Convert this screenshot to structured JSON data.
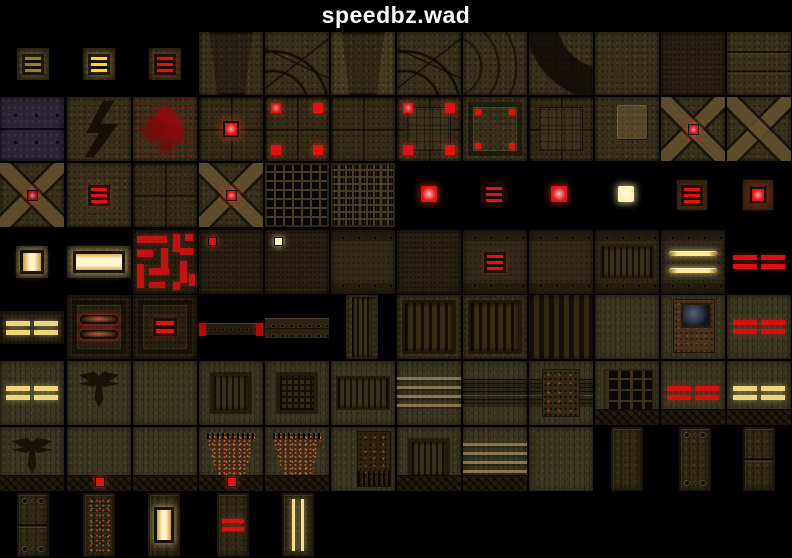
{
  "header": {
    "title": "speedbz.wad"
  },
  "palette": {
    "background": "#000000",
    "title_text": "#ffffff",
    "red_light": "#e01212",
    "red_glow": "rgba(255,60,30,0.45)",
    "yellow_light": "#ffd81e",
    "yellow_pairs": "#edd77a",
    "dim_yellow": "#97831e",
    "white_light": "#fff3b0",
    "brown_base": "#39301c",
    "olive_base": "#3b3622"
  },
  "tiles": [
    {
      "name": "light-sm-yellow-dim",
      "x": 17,
      "y": 48,
      "w": 32,
      "h": 32,
      "b": "brown",
      "l": [
        "bars3"
      ],
      "a": "#97831e",
      "g": "rgba(200,180,70,0.4)"
    },
    {
      "name": "light-sm-yellow",
      "x": 83,
      "y": 48,
      "w": 32,
      "h": 32,
      "b": "brown",
      "l": [
        "bars3"
      ],
      "a": "#ffd81e",
      "g": "rgba(255,220,80,0.5)"
    },
    {
      "name": "light-sm-red",
      "x": 149,
      "y": 48,
      "w": 32,
      "h": 32,
      "b": "brown",
      "l": [
        "bars3"
      ]
    },
    {
      "name": "arch-keystone-dark",
      "x": 199,
      "y": 32,
      "w": 64,
      "h": 63,
      "b": "brown",
      "l": [
        "trap"
      ]
    },
    {
      "name": "arch-stones",
      "x": 265,
      "y": 32,
      "w": 64,
      "h": 63,
      "b": "brown",
      "l": [
        "stones"
      ]
    },
    {
      "name": "arch-keystone",
      "x": 331,
      "y": 32,
      "w": 64,
      "h": 63,
      "b": "brownb",
      "l": [
        "trap"
      ]
    },
    {
      "name": "arch-corner-stones",
      "x": 397,
      "y": 32,
      "w": 64,
      "h": 63,
      "b": "brown",
      "l": [
        "stones"
      ]
    },
    {
      "name": "arch-curve-lines",
      "x": 463,
      "y": 32,
      "w": 64,
      "h": 63,
      "b": "brown",
      "l": [
        "arcs"
      ]
    },
    {
      "name": "arch-curve-dark",
      "x": 529,
      "y": 32,
      "w": 64,
      "h": 63,
      "b": "brown",
      "l": [
        "arcdark"
      ]
    },
    {
      "name": "wall-plain",
      "x": 595,
      "y": 32,
      "w": 64,
      "h": 63,
      "b": "brown",
      "l": []
    },
    {
      "name": "wall-dark",
      "x": 661,
      "y": 32,
      "w": 64,
      "h": 63,
      "b": "brownd",
      "l": []
    },
    {
      "name": "wall-seams",
      "x": 727,
      "y": 32,
      "w": 64,
      "h": 63,
      "b": "brown",
      "l": [
        "seams"
      ]
    },
    {
      "name": "plate-rivets",
      "x": 0,
      "y": 97,
      "w": 64,
      "h": 64,
      "b": "plates",
      "l": []
    },
    {
      "name": "wall-conduit-bolt",
      "x": 67,
      "y": 97,
      "w": 64,
      "h": 64,
      "b": "brown",
      "l": [
        "zigzag"
      ]
    },
    {
      "name": "wall-blood",
      "x": 133,
      "y": 97,
      "w": 64,
      "h": 64,
      "b": "brown",
      "l": [
        "blood"
      ]
    },
    {
      "name": "floor-light-center",
      "x": 199,
      "y": 97,
      "w": 64,
      "h": 64,
      "b": "floor",
      "l": [
        "glowc"
      ]
    },
    {
      "name": "floor-lights-corners",
      "x": 265,
      "y": 97,
      "w": 64,
      "h": 64,
      "b": "floor",
      "l": [
        "corners"
      ]
    },
    {
      "name": "floor-plain",
      "x": 331,
      "y": 97,
      "w": 64,
      "h": 64,
      "b": "floor",
      "l": []
    },
    {
      "name": "floor-lights-corners-grid",
      "x": 397,
      "y": 97,
      "w": 64,
      "h": 64,
      "b": "floor",
      "l": [
        "insetgrid",
        "corners"
      ]
    },
    {
      "name": "panel-corner-lights",
      "x": 463,
      "y": 97,
      "w": 64,
      "h": 64,
      "b": "brown",
      "l": [
        "frame",
        "cornerdots"
      ]
    },
    {
      "name": "floor-inset-grid",
      "x": 529,
      "y": 97,
      "w": 64,
      "h": 64,
      "b": "floor",
      "l": [
        "insetgrid"
      ]
    },
    {
      "name": "wall-hatch-panel",
      "x": 595,
      "y": 97,
      "w": 64,
      "h": 64,
      "b": "brown",
      "l": [
        "panellight"
      ]
    },
    {
      "name": "cross-light-red",
      "x": 661,
      "y": 97,
      "w": 64,
      "h": 64,
      "b": "brown",
      "l": [
        "xcross",
        "dotglow"
      ]
    },
    {
      "name": "cross-plain",
      "x": 727,
      "y": 97,
      "w": 64,
      "h": 64,
      "b": "brown",
      "l": [
        "xcross"
      ]
    },
    {
      "name": "cross-light-dim",
      "x": 0,
      "y": 163,
      "w": 64,
      "h": 64,
      "b": "brown",
      "l": [
        "xcross",
        "dotglow"
      ],
      "a": "#a31010",
      "g": "rgba(200,40,25,0.3)"
    },
    {
      "name": "wall-red-bars",
      "x": 67,
      "y": 163,
      "w": 64,
      "h": 64,
      "b": "brown",
      "l": [
        "bars3"
      ]
    },
    {
      "name": "floor-tiles",
      "x": 133,
      "y": 163,
      "w": 64,
      "h": 64,
      "b": "floor",
      "l": []
    },
    {
      "name": "cross-light-red2",
      "x": 199,
      "y": 163,
      "w": 64,
      "h": 64,
      "b": "brown",
      "l": [
        "xcross",
        "dotglow"
      ]
    },
    {
      "name": "grate-dark",
      "x": 265,
      "y": 163,
      "w": 64,
      "h": 64,
      "b": "grate",
      "l": []
    },
    {
      "name": "grate-dense",
      "x": 331,
      "y": 163,
      "w": 64,
      "h": 64,
      "b": "grate2",
      "l": []
    },
    {
      "name": "light-red-sq",
      "x": 420,
      "y": 185,
      "w": 18,
      "h": 18,
      "b": "black",
      "l": [
        "glowfill"
      ]
    },
    {
      "name": "light-red-bars",
      "x": 485,
      "y": 185,
      "w": 18,
      "h": 18,
      "b": "black",
      "l": [
        "bars3"
      ]
    },
    {
      "name": "light-red-spike",
      "x": 550,
      "y": 185,
      "w": 18,
      "h": 18,
      "b": "black",
      "l": [
        "glowfill"
      ]
    },
    {
      "name": "light-white-spike",
      "x": 617,
      "y": 185,
      "w": 18,
      "h": 18,
      "b": "black",
      "l": [
        "glowfill"
      ],
      "a": "#fff3b0",
      "g": "rgba(255,240,180,0.6)"
    },
    {
      "name": "light-framed-bars",
      "x": 676,
      "y": 179,
      "w": 32,
      "h": 32,
      "b": "brown",
      "l": [
        "frame2",
        "bars3"
      ]
    },
    {
      "name": "light-framed-red",
      "x": 742,
      "y": 179,
      "w": 32,
      "h": 32,
      "b": "brown",
      "l": [
        "frame2",
        "glowc"
      ]
    },
    {
      "name": "light-window-sm",
      "x": 16,
      "y": 246,
      "w": 32,
      "h": 32,
      "b": "brown",
      "l": [
        "window"
      ]
    },
    {
      "name": "light-window-wide",
      "x": 67,
      "y": 246,
      "w": 64,
      "h": 32,
      "b": "brown",
      "l": [
        "windowwide"
      ]
    },
    {
      "name": "pipes-red-maze",
      "x": 133,
      "y": 230,
      "w": 64,
      "h": 64,
      "b": "brownd",
      "l": [
        "pipes"
      ]
    },
    {
      "name": "wall-mini-light-red",
      "x": 199,
      "y": 230,
      "w": 64,
      "h": 64,
      "b": "brownd",
      "l": [
        "minilight"
      ]
    },
    {
      "name": "wall-mini-light-white",
      "x": 265,
      "y": 230,
      "w": 64,
      "h": 64,
      "b": "brownd",
      "l": [
        "minilight"
      ],
      "a": "#fff3c0",
      "g": "rgba(255,240,180,0.55)"
    },
    {
      "name": "wall-riveted",
      "x": 331,
      "y": 230,
      "w": 64,
      "h": 64,
      "b": "rivets",
      "l": []
    },
    {
      "name": "wall-rough",
      "x": 397,
      "y": 230,
      "w": 64,
      "h": 64,
      "b": "brownd",
      "l": []
    },
    {
      "name": "wall-red-bars-box",
      "x": 463,
      "y": 230,
      "w": 64,
      "h": 64,
      "b": "rivets",
      "l": [
        "bars3"
      ]
    },
    {
      "name": "wall-riveted2",
      "x": 529,
      "y": 230,
      "w": 64,
      "h": 64,
      "b": "rivets",
      "l": []
    },
    {
      "name": "wall-vent-band",
      "x": 595,
      "y": 230,
      "w": 64,
      "h": 64,
      "b": "rivets",
      "l": [
        "ventband"
      ]
    },
    {
      "name": "wall-yellow-strips",
      "x": 661,
      "y": 230,
      "w": 64,
      "h": 64,
      "b": "rivets",
      "l": [
        "strips2"
      ]
    },
    {
      "name": "strip-red-pairs",
      "x": 727,
      "y": 245,
      "w": 64,
      "h": 33,
      "b": "black",
      "l": [
        "pairs"
      ],
      "a": "#d81010",
      "g": "rgba(255,48,24,0.45)"
    },
    {
      "name": "strip-yellow-pairs",
      "x": 0,
      "y": 311,
      "w": 64,
      "h": 33,
      "b": "brownd",
      "l": [
        "pairs"
      ],
      "a": "#edd77a",
      "g": "rgba(255,232,150,0.5)"
    },
    {
      "name": "panel-red-capsules",
      "x": 67,
      "y": 295,
      "w": 64,
      "h": 64,
      "b": "brownd",
      "l": [
        "frame",
        "capsules"
      ]
    },
    {
      "name": "panel-red-bars-sm",
      "x": 133,
      "y": 295,
      "w": 64,
      "h": 64,
      "b": "brownd",
      "l": [
        "frame",
        "bars2"
      ]
    },
    {
      "name": "beam-thin",
      "x": 199,
      "y": 323,
      "w": 64,
      "h": 13,
      "b": "beam",
      "l": [
        "ends"
      ],
      "a": "#b00c0c"
    },
    {
      "name": "beam-riveted",
      "x": 265,
      "y": 318,
      "w": 64,
      "h": 21,
      "b": "beam2",
      "l": []
    },
    {
      "name": "slats-narrow",
      "x": 346,
      "y": 295,
      "w": 32,
      "h": 64,
      "b": "brown",
      "l": [
        "slatsv"
      ]
    },
    {
      "name": "vent-framed-a",
      "x": 397,
      "y": 295,
      "w": 64,
      "h": 64,
      "b": "brown",
      "l": [
        "ventframed"
      ]
    },
    {
      "name": "vent-framed-b",
      "x": 463,
      "y": 295,
      "w": 64,
      "h": 64,
      "b": "brown",
      "l": [
        "ventframed"
      ]
    },
    {
      "name": "wall-dark-stripes",
      "x": 529,
      "y": 295,
      "w": 64,
      "h": 64,
      "b": "stripesdark",
      "l": []
    },
    {
      "name": "wall-olive-plain",
      "x": 595,
      "y": 295,
      "w": 64,
      "h": 64,
      "b": "olive",
      "l": []
    },
    {
      "name": "wall-terminal",
      "x": 661,
      "y": 295,
      "w": 64,
      "h": 64,
      "b": "olive",
      "l": [
        "terminal"
      ]
    },
    {
      "name": "wall-red-pairs",
      "x": 727,
      "y": 295,
      "w": 64,
      "h": 64,
      "b": "olive",
      "l": [
        "pairs"
      ],
      "a": "#d81010",
      "g": "rgba(255,48,24,0.45)"
    },
    {
      "name": "olive-yellow-pairs",
      "x": 0,
      "y": 361,
      "w": 64,
      "h": 64,
      "b": "olive",
      "l": [
        "pairs"
      ],
      "a": "#edd77a",
      "g": "rgba(255,232,150,0.5)"
    },
    {
      "name": "olive-emblem",
      "x": 67,
      "y": 361,
      "w": 64,
      "h": 64,
      "b": "olive",
      "l": [
        "emblem"
      ]
    },
    {
      "name": "olive-plain",
      "x": 133,
      "y": 361,
      "w": 64,
      "h": 64,
      "b": "olive",
      "l": []
    },
    {
      "name": "olive-vent-slats",
      "x": 199,
      "y": 361,
      "w": 64,
      "h": 64,
      "b": "olive",
      "l": [
        "ventsq"
      ]
    },
    {
      "name": "olive-vent-grid",
      "x": 265,
      "y": 361,
      "w": 64,
      "h": 64,
      "b": "olive",
      "l": [
        "ventsqgrid"
      ]
    },
    {
      "name": "olive-vent-band",
      "x": 331,
      "y": 361,
      "w": 64,
      "h": 64,
      "b": "olive",
      "l": [
        "ventband"
      ]
    },
    {
      "name": "olive-stripes",
      "x": 397,
      "y": 361,
      "w": 64,
      "h": 64,
      "b": "olive",
      "l": [
        "hstripes"
      ]
    },
    {
      "name": "olive-tech-strip",
      "x": 463,
      "y": 361,
      "w": 64,
      "h": 64,
      "b": "olive",
      "l": [
        "techstrip"
      ]
    },
    {
      "name": "olive-machinery",
      "x": 529,
      "y": 361,
      "w": 64,
      "h": 64,
      "b": "olive",
      "l": [
        "techstrip",
        "machinery"
      ]
    },
    {
      "name": "olive-grate-window",
      "x": 595,
      "y": 361,
      "w": 64,
      "h": 64,
      "b": "olive",
      "l": [
        "gratewin",
        "base"
      ]
    },
    {
      "name": "olive-red-pairs-base",
      "x": 661,
      "y": 361,
      "w": 64,
      "h": 64,
      "b": "olive",
      "l": [
        "pairs",
        "base"
      ],
      "a": "#d81010",
      "g": "rgba(255,48,24,0.45)"
    },
    {
      "name": "olive-yellow-pairs-base",
      "x": 727,
      "y": 361,
      "w": 64,
      "h": 64,
      "b": "olive",
      "l": [
        "pairs",
        "base"
      ],
      "a": "#edd77a",
      "g": "rgba(255,232,150,0.5)"
    },
    {
      "name": "olive-emblem-base",
      "x": 0,
      "y": 427,
      "w": 64,
      "h": 64,
      "b": "olive",
      "l": [
        "emblem",
        "base"
      ]
    },
    {
      "name": "olive-base-light",
      "x": 67,
      "y": 427,
      "w": 64,
      "h": 64,
      "b": "olive",
      "l": [
        "base",
        "baselight"
      ]
    },
    {
      "name": "olive-base-plain",
      "x": 133,
      "y": 427,
      "w": 64,
      "h": 64,
      "b": "olive",
      "l": [
        "base"
      ]
    },
    {
      "name": "olive-circuit-trap-light",
      "x": 199,
      "y": 427,
      "w": 64,
      "h": 64,
      "b": "olive",
      "l": [
        "trapcircuit",
        "base",
        "baselight"
      ]
    },
    {
      "name": "olive-circuit-trap",
      "x": 265,
      "y": 427,
      "w": 64,
      "h": 64,
      "b": "olive",
      "l": [
        "trapcircuit",
        "base"
      ]
    },
    {
      "name": "olive-circuit-board",
      "x": 331,
      "y": 427,
      "w": 64,
      "h": 64,
      "b": "olive",
      "l": [
        "circuit"
      ]
    },
    {
      "name": "olive-vent-base",
      "x": 397,
      "y": 427,
      "w": 64,
      "h": 64,
      "b": "olive",
      "l": [
        "ventsq",
        "base"
      ]
    },
    {
      "name": "olive-stripes-base",
      "x": 463,
      "y": 427,
      "w": 64,
      "h": 64,
      "b": "olive",
      "l": [
        "hstripes",
        "base"
      ]
    },
    {
      "name": "olive-planks",
      "x": 529,
      "y": 427,
      "w": 64,
      "h": 64,
      "b": "olive",
      "l": []
    },
    {
      "name": "door-planks",
      "x": 611,
      "y": 427,
      "w": 32,
      "h": 64,
      "b": "door",
      "l": []
    },
    {
      "name": "door-planks-bolts",
      "x": 679,
      "y": 427,
      "w": 32,
      "h": 64,
      "b": "door",
      "l": [
        "bolts"
      ]
    },
    {
      "name": "door-planks-split",
      "x": 743,
      "y": 427,
      "w": 32,
      "h": 64,
      "b": "door",
      "l": [
        "split"
      ]
    },
    {
      "name": "door-metal-bolts",
      "x": 17,
      "y": 493,
      "w": 32,
      "h": 64,
      "b": "door",
      "l": [
        "bolts",
        "split"
      ]
    },
    {
      "name": "door-circuit",
      "x": 83,
      "y": 493,
      "w": 32,
      "h": 64,
      "b": "door",
      "l": [
        "doorcircuit"
      ]
    },
    {
      "name": "door-light-window",
      "x": 148,
      "y": 493,
      "w": 32,
      "h": 64,
      "b": "door",
      "l": [
        "doorwindow"
      ]
    },
    {
      "name": "door-red-bars",
      "x": 217,
      "y": 493,
      "w": 32,
      "h": 64,
      "b": "door",
      "l": [
        "doorbars"
      ],
      "a": "#d81010",
      "g": "rgba(255,48,24,0.5)"
    },
    {
      "name": "door-yellow-strips",
      "x": 282,
      "y": 493,
      "w": 32,
      "h": 64,
      "b": "door",
      "l": [
        "doorvstrips"
      ]
    }
  ]
}
